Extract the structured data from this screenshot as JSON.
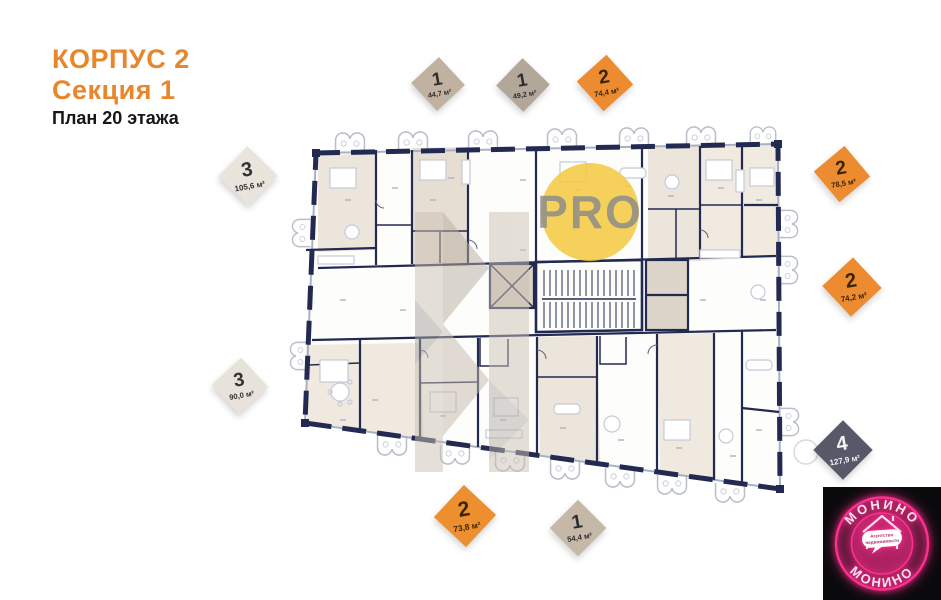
{
  "header": {
    "building": "КОРПУС 2",
    "section": "Секция 1",
    "floor_plan": "План 20 этажа",
    "accent_color": "#e8862b"
  },
  "apartment_labels": [
    {
      "rooms": "1",
      "area": "44,7 м²",
      "bg": "#c0b1a1",
      "fg": "#2d2d2d",
      "x": 438,
      "y": 84,
      "size": "38px",
      "rot": "47deg"
    },
    {
      "rooms": "1",
      "area": "49,2 м²",
      "bg": "#b3a799",
      "fg": "#2d2d2d",
      "x": 523,
      "y": 85,
      "size": "38px",
      "rot": "44deg"
    },
    {
      "rooms": "2",
      "area": "74,4 м²",
      "bg": "#ed8b30",
      "fg": "#3a2408",
      "x": 605,
      "y": 83,
      "size": "40px",
      "rot": "48deg"
    },
    {
      "rooms": "2",
      "area": "78,5 м²",
      "bg": "#ed8b30",
      "fg": "#3a2408",
      "x": 842,
      "y": 174,
      "size": "40px",
      "rot": "50deg"
    },
    {
      "rooms": "2",
      "area": "74,2 м²",
      "bg": "#ed8b30",
      "fg": "#3a2408",
      "x": 852,
      "y": 287,
      "size": "42px",
      "rot": "47deg"
    },
    {
      "rooms": "4",
      "area": "127,9 м²",
      "bg": "#585968",
      "fg": "#f3f3f5",
      "x": 843,
      "y": 450,
      "size": "42px",
      "rot": "45deg"
    },
    {
      "rooms": "3",
      "area": "105,6 м²",
      "bg": "#e9e4dc",
      "fg": "#333333",
      "x": 248,
      "y": 176,
      "size": "42px",
      "rot": "44deg"
    },
    {
      "rooms": "3",
      "area": "90,0 м²",
      "bg": "#e7e2da",
      "fg": "#333333",
      "x": 240,
      "y": 386,
      "size": "40px",
      "rot": "47deg"
    },
    {
      "rooms": "2",
      "area": "73,8 м²",
      "bg": "#ee8f2f",
      "fg": "#3a2408",
      "x": 465,
      "y": 516,
      "size": "44px",
      "rot": "43deg"
    },
    {
      "rooms": "1",
      "area": "54,4 м²",
      "bg": "#c5b8a6",
      "fg": "#2d2d2d",
      "x": 578,
      "y": 528,
      "size": "40px",
      "rot": "45deg"
    }
  ],
  "watermarks": {
    "pro": {
      "label": "PRO",
      "circle_color": "#f3c93f",
      "text_color": "#87878b"
    }
  },
  "floor_plan": {
    "wall_color": "#232a52",
    "room_tint": "#ece5db",
    "furniture_color": "#c6cad6"
  },
  "logo": {
    "brand_top": "МОНИНО",
    "brand_bottom": "МОНИНО",
    "tagline_line1": "Агентство",
    "tagline_line2": "недвижимости",
    "bg": "#0a0a0c",
    "neon": "#ff2f8e"
  }
}
